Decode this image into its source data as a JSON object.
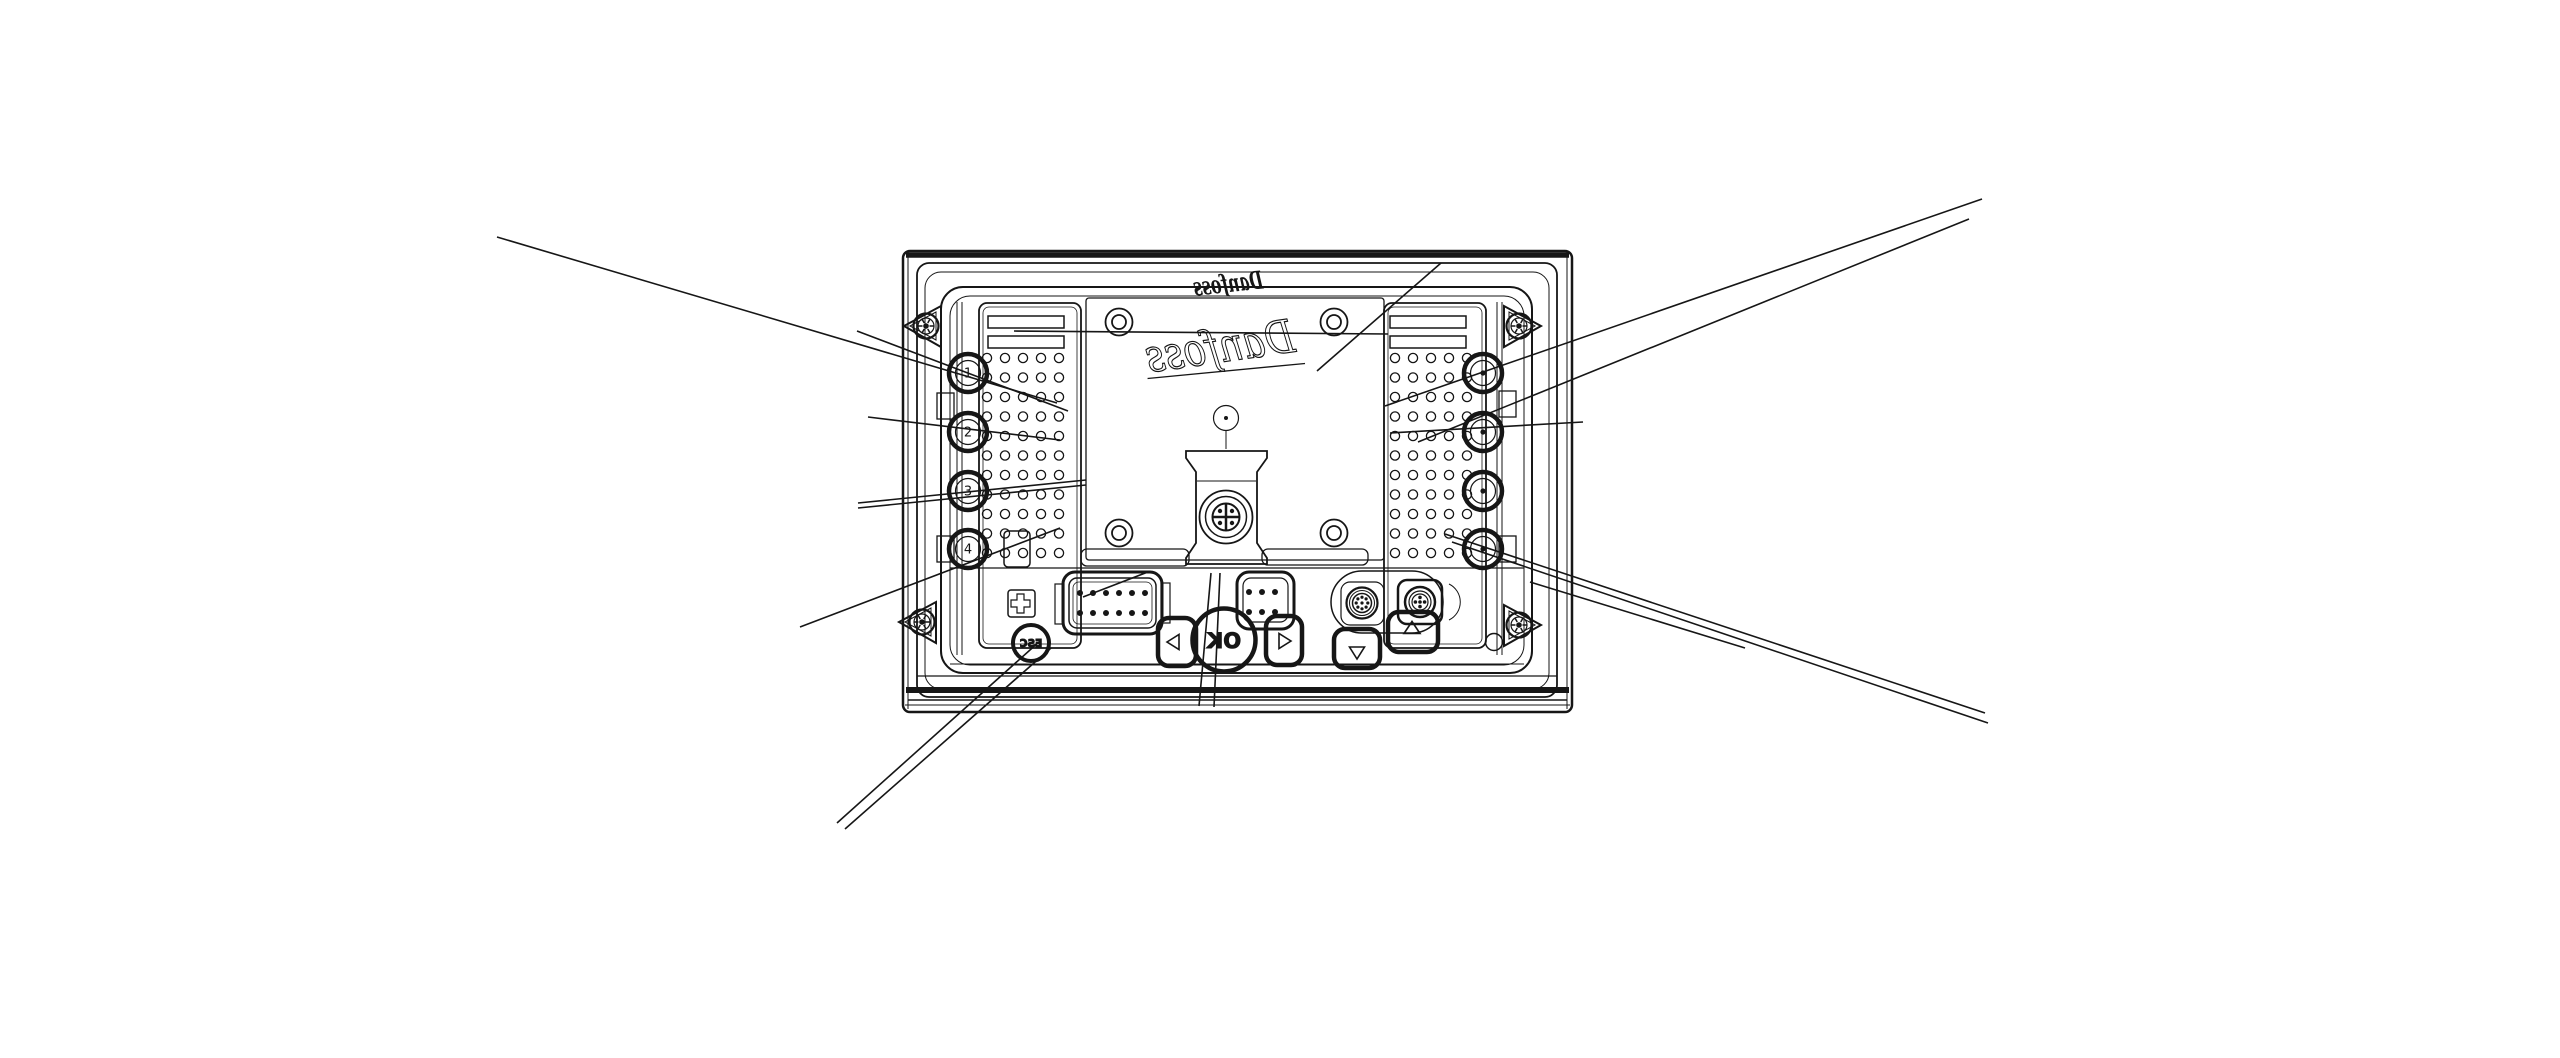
{
  "figure": {
    "type": "technical-drawing-rear-view",
    "brand_logo_large": "Danfoss",
    "brand_logo_small": "Danfoss",
    "front_buttons": {
      "esc": "ESC",
      "ok": "OK"
    },
    "knockout_labels_left": [
      "1",
      "2",
      "3",
      "4"
    ],
    "colors": {
      "ink": "#161616",
      "bg": "#ffffff"
    },
    "perforation": {
      "rows": 11,
      "cols": 5,
      "col_step": 18,
      "row_step": 19.5,
      "radius": 4.6,
      "left_x0": 987,
      "right_x0": 1395,
      "y0": 358
    },
    "knockouts": {
      "left_cx": 968,
      "right_cx": 1483,
      "cys": [
        373,
        432,
        491,
        549
      ]
    },
    "corner_screws": [
      [
        926,
        326
      ],
      [
        922,
        622
      ],
      [
        1519,
        326
      ],
      [
        1519,
        625
      ]
    ],
    "pins": {
      "dsub12": {
        "xs": [
          1080,
          1093,
          1106,
          1119,
          1132,
          1145
        ],
        "ys": [
          593,
          613
        ],
        "r": 3
      },
      "conn6": {
        "xs": [
          1249,
          1262,
          1275
        ],
        "ys": [
          592,
          612
        ],
        "r": 3
      },
      "m12_a": {
        "cx": 1362,
        "cy": 603,
        "ring_r": 5.8,
        "count": 8,
        "pin_r": 1.6
      },
      "m12_b": {
        "cx": 1420,
        "cy": 602,
        "ring_r": 4.6,
        "count": 4,
        "pin_r": 1.8
      }
    },
    "leader_lines": [
      [
        497,
        237,
        1057,
        403
      ],
      [
        857,
        331,
        1068,
        411
      ],
      [
        868,
        417,
        1060,
        440
      ],
      [
        858,
        503,
        1086,
        480
      ],
      [
        858,
        508,
        1086,
        485
      ],
      [
        800,
        627,
        1060,
        528
      ],
      [
        837,
        823,
        1040,
        641
      ],
      [
        845,
        829,
        1051,
        648
      ],
      [
        1083,
        597,
        1148,
        572
      ],
      [
        1014,
        331,
        1388,
        334
      ],
      [
        1385,
        406,
        1982,
        199
      ],
      [
        1418,
        442,
        1969,
        219
      ],
      [
        1390,
        433,
        1583,
        422
      ],
      [
        1445,
        534,
        1985,
        713
      ],
      [
        1452,
        542,
        1988,
        723
      ],
      [
        1530,
        582,
        1745,
        648
      ],
      [
        1441,
        263,
        1317,
        371
      ],
      [
        1211,
        573,
        1199,
        706
      ],
      [
        1220,
        573,
        1214,
        707
      ]
    ]
  }
}
